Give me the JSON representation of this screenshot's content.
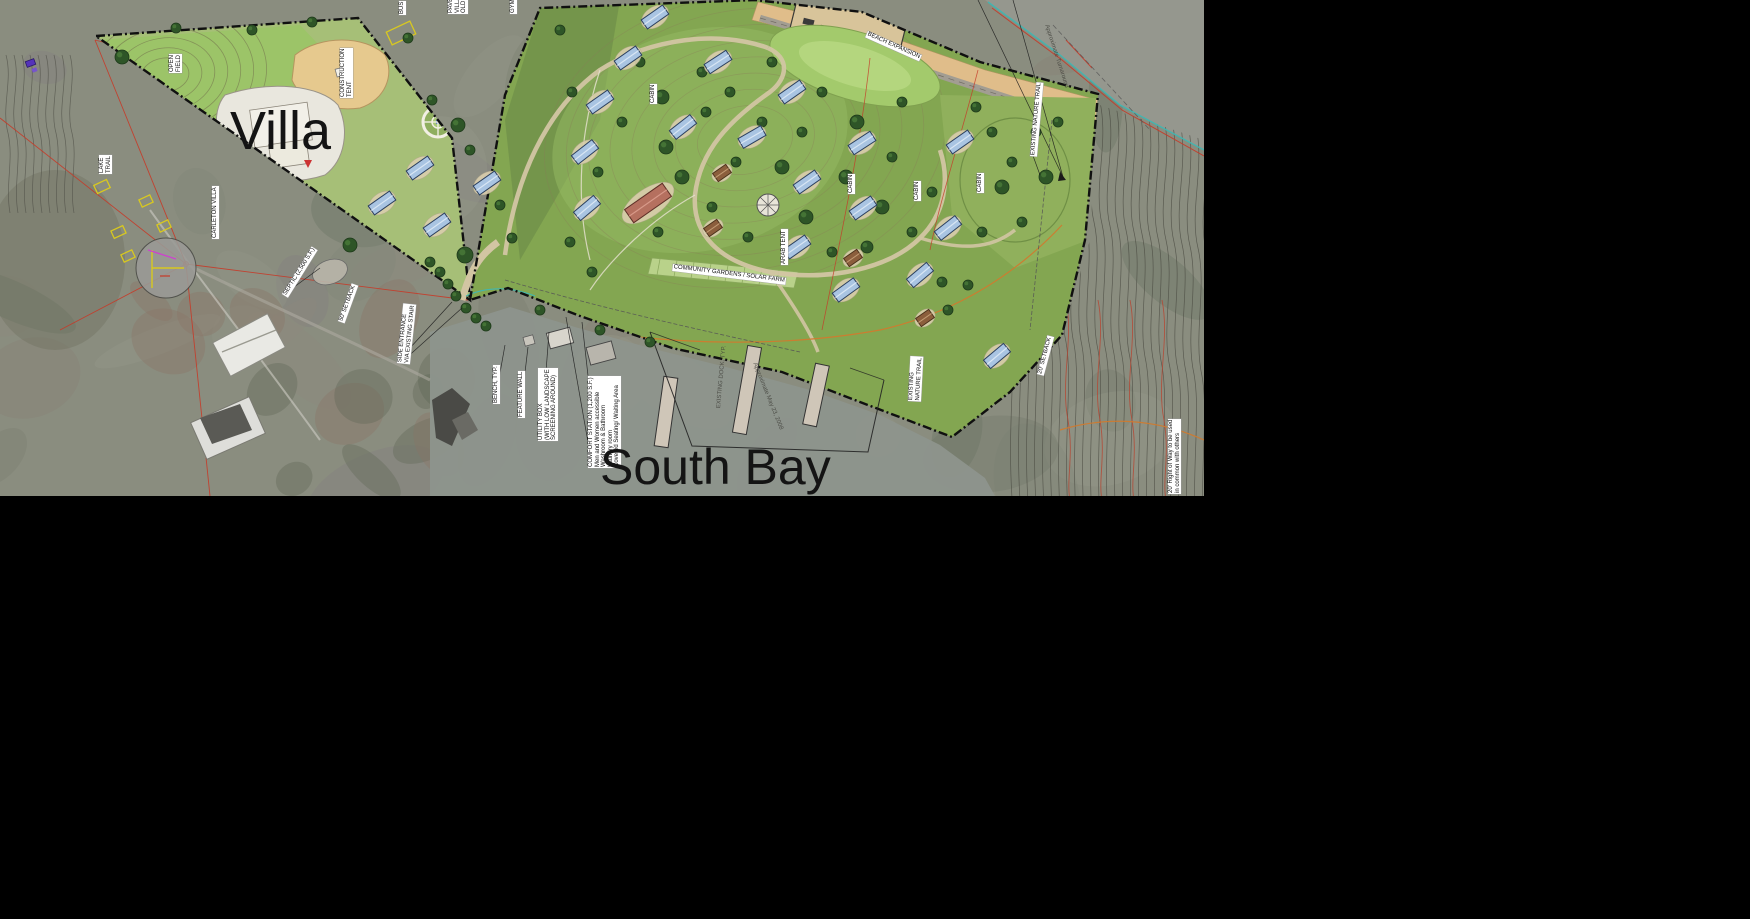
{
  "map": {
    "big_labels": {
      "villa": "Villa",
      "south_bay": "South Bay"
    },
    "labels": [
      {
        "text": "OPEN|FIELD",
        "x": 169,
        "y": 73,
        "rot": -90,
        "type": "vm"
      },
      {
        "text": "CONSTRUCTION|TENT",
        "x": 340,
        "y": 98,
        "rot": -90,
        "type": "vm"
      },
      {
        "text": "LAKE|TRAIL",
        "x": 99,
        "y": 174,
        "rot": -90,
        "type": "vm"
      },
      {
        "text": "CARLETON VILLA",
        "x": 212,
        "y": 239,
        "rot": -90,
        "type": "v"
      },
      {
        "text": "SEPTIC (2,500 S.F.)",
        "x": 282,
        "y": 294,
        "rot": -58,
        "type": "v"
      },
      {
        "text": "50' SETBACK",
        "x": 338,
        "y": 321,
        "rot": -70,
        "type": "v"
      },
      {
        "text": "SIDE ENTRANCE|VIA EXISTING STAIR",
        "x": 397,
        "y": 363,
        "rot": -84,
        "type": "vm"
      },
      {
        "text": "BENCH, TYP.",
        "x": 493,
        "y": 404,
        "rot": -90,
        "type": "v"
      },
      {
        "text": "FEATURE WALL",
        "x": 518,
        "y": 418,
        "rot": -90,
        "type": "v"
      },
      {
        "text": "UTILITY BOX|(WITH LOW LANDSCAPE|SCREENING AROUND)",
        "x": 538,
        "y": 441,
        "rot": -90,
        "type": "vm"
      },
      {
        "text": "COMFORT STATION (1,200 S.F.)|Men and Women accessible|Washroom & Bathroom|Laundry room|Covered Seating/ Waiting Area",
        "x": 588,
        "y": 468,
        "rot": -90,
        "type": "vm"
      },
      {
        "text": "BEACH EXPANSION",
        "x": 868,
        "y": 31,
        "rot": 24,
        "type": "d"
      },
      {
        "text": "COMMUNITY GARDENS / SOLAR FARM",
        "x": 673,
        "y": 264,
        "rot": 7,
        "type": "d"
      },
      {
        "text": "ARAB TENT",
        "x": 781,
        "y": 265,
        "rot": -90,
        "type": "v"
      },
      {
        "text": "CABIN",
        "x": 650,
        "y": 104,
        "rot": -90,
        "type": "v"
      },
      {
        "text": "CABIN",
        "x": 848,
        "y": 194,
        "rot": -90,
        "type": "v"
      },
      {
        "text": "CABIN",
        "x": 914,
        "y": 201,
        "rot": -90,
        "type": "v"
      },
      {
        "text": "CABIN",
        "x": 977,
        "y": 193,
        "rot": -90,
        "type": "v"
      },
      {
        "text": "EXISTING NATURE TRAIL",
        "x": 1030,
        "y": 156,
        "rot": -85,
        "type": "v"
      },
      {
        "text": "EXISTING|NATURE TRAIL",
        "x": 908,
        "y": 401,
        "rot": -87,
        "type": "vm"
      },
      {
        "text": "20' SETBACK",
        "x": 1037,
        "y": 374,
        "rot": -75,
        "type": "v"
      },
      {
        "text": "20' Right of Way to be used|in common with others",
        "x": 1168,
        "y": 494,
        "rot": -90,
        "type": "vm"
      },
      {
        "text": "EXISTING DOCK, TYP.",
        "x": 716,
        "y": 408,
        "rot": -85,
        "type": "t"
      },
      {
        "text": "Approximate May 23, 2008",
        "x": 757,
        "y": 362,
        "rot": 68,
        "type": "t"
      },
      {
        "text": "Approximate Turnaround",
        "x": 1049,
        "y": 24,
        "rot": 72,
        "type": "t"
      },
      {
        "text": "BUS",
        "x": 399,
        "y": 15,
        "rot": -90,
        "type": "v"
      },
      {
        "text": "PAVED|VILLA|OLD TO",
        "x": 448,
        "y": 14,
        "rot": -90,
        "type": "vm"
      },
      {
        "text": "GYM",
        "x": 510,
        "y": 14,
        "rot": -90,
        "type": "v"
      }
    ]
  },
  "colors": {
    "background": "#000000",
    "plan_green": "#83a651",
    "field_green": "#9cc468",
    "path_tan": "#d2c5a3",
    "beach_sand": "#e0bd8a",
    "water_gray": "#8e948d",
    "tree_green": "#2e5527",
    "cabin_roof_blue": "#a9c4e2",
    "lodge_roof": "#b5705f",
    "boundary_black": "#101010",
    "survey_red": "#c63a28",
    "contour_orange": "#d07a2e",
    "shore_cyan": "#3fb6b2",
    "label_bg": "#ffffff"
  }
}
